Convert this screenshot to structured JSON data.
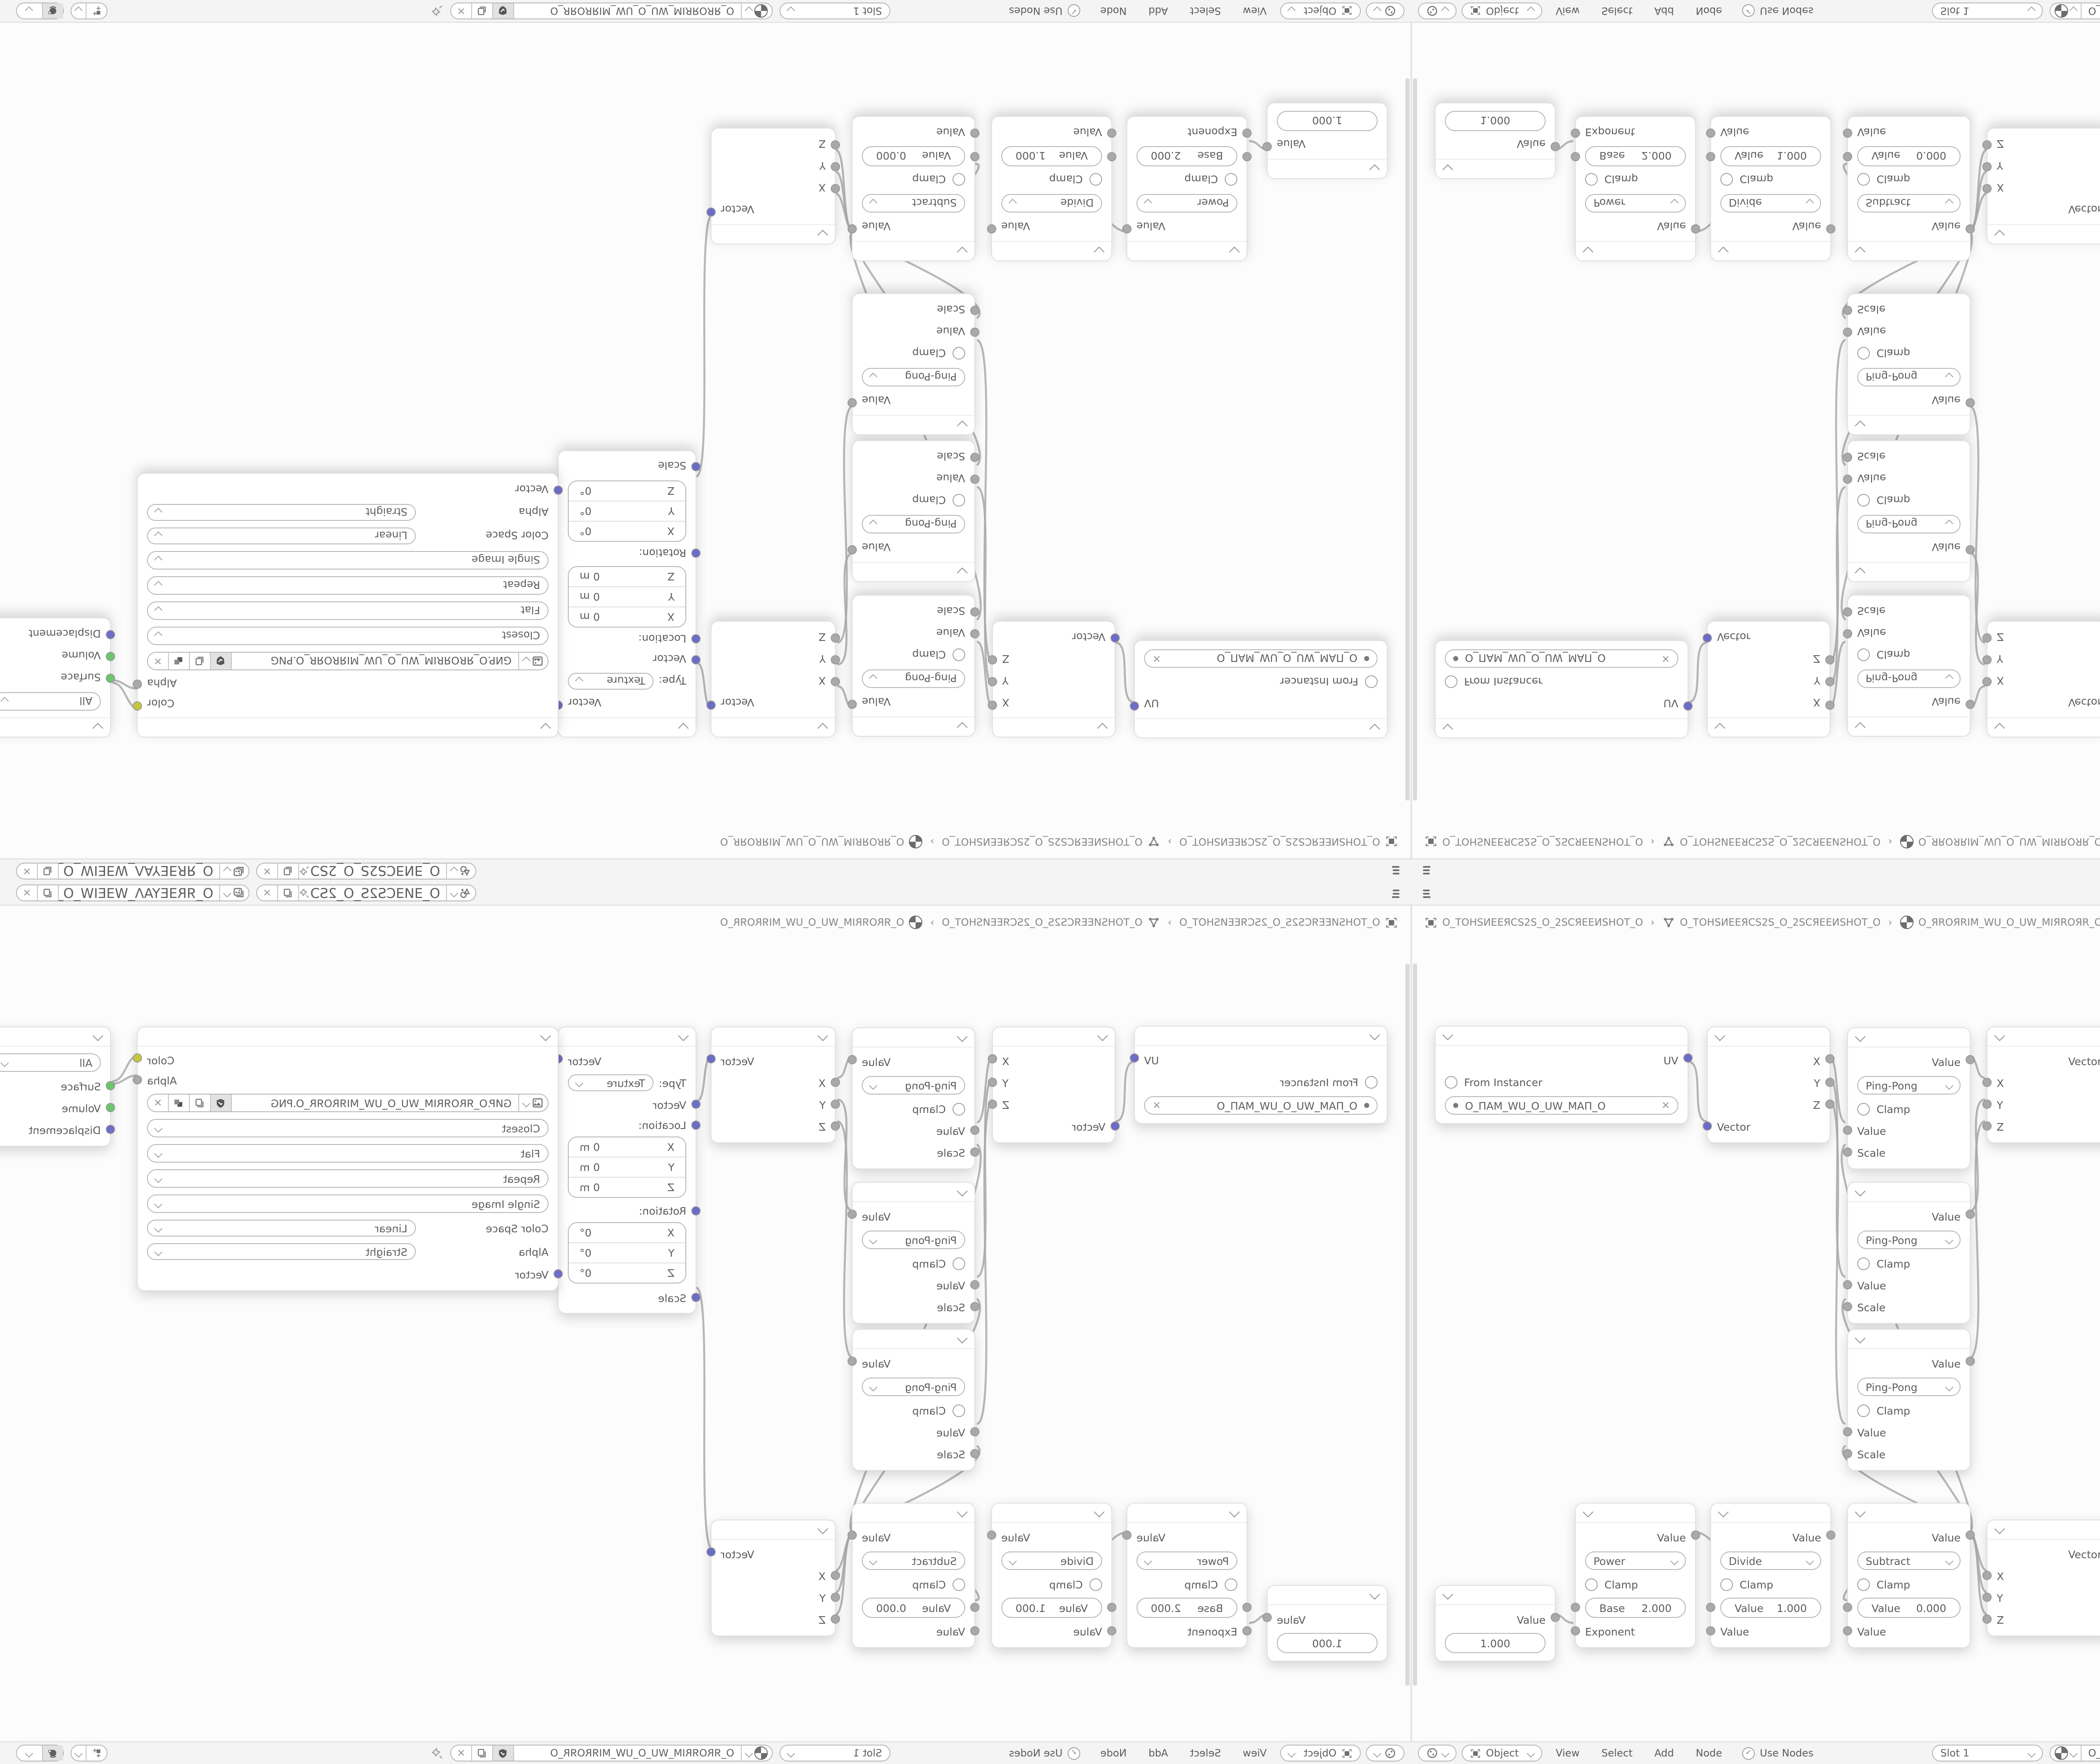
{
  "topbar": {
    "scene": "O_ƎИƎCS2S_O_2SƆƎИ...",
    "view_layer": "O_ЯRƎEYAΛ_WƎEIW_O_WIƎEW_ΛAYƎEЯR_O"
  },
  "breadcrumb": {
    "screen": "O_TOHSИEEЯCS2S_O_2SCЯEEИSHOT_O",
    "nodetree": "O_TOHSИEEЯCS2S_O_2SCЯEEИSHOT_O",
    "material": "O_ЯROЯRIM_WU_O_UW_MIЯROЯR_O",
    "sep": "›"
  },
  "header": {
    "shader_type": "Object",
    "menus": [
      "View",
      "Select",
      "Add",
      "Node"
    ],
    "use_nodes": "Use Nodes",
    "slot": "Slot 1",
    "material": "O_ЯROЯRIM_WU_O_UW_MIЯROЯR_O"
  },
  "nodes": {
    "uv_map": {
      "output": "UV",
      "from_instancer": "From Instancer",
      "uv_name": "O_ПAM_WU_O_UW_MAП_O"
    },
    "separate_xyz": {
      "x": "X",
      "y": "Y",
      "z": "Z",
      "vector": "Vector"
    },
    "pingpong": {
      "output": "Value",
      "operation": "Ping-Pong",
      "clamp": "Clamp",
      "value": "Value",
      "scale": "Scale"
    },
    "combine_xyz": {
      "output": "Vector",
      "x": "X",
      "y": "Y",
      "z": "Z"
    },
    "mapping": {
      "output": "Vector",
      "type_label": "Type:",
      "type": "Texture",
      "vector": "Vector",
      "location": {
        "label": "Location:",
        "rows": [
          [
            "X",
            "0 m"
          ],
          [
            "Y",
            "0 m"
          ],
          [
            "Z",
            "0 m"
          ]
        ]
      },
      "rotation": {
        "label": "Rotation:",
        "rows": [
          [
            "X",
            "0°"
          ],
          [
            "Y",
            "0°"
          ],
          [
            "Z",
            "0°"
          ]
        ]
      },
      "scale": "Scale"
    },
    "image": {
      "color": "Color",
      "alpha": "Alpha",
      "filename": "GИP.O_ЯROЯRIM_WU_O_UW_MIЯROЯR_O.PNG",
      "interpolation": "Closest",
      "projection": "Flat",
      "extension": "Repeat",
      "source": "Single Image",
      "color_space_label": "Color Space",
      "color_space": "Linear",
      "alpha_label": "Alpha",
      "alpha_mode": "Straight",
      "vector": "Vector"
    },
    "output": {
      "target": "All",
      "surface": "Surface",
      "volume": "Volume",
      "displacement": "Displacement"
    },
    "value": {
      "output": "Value",
      "value": "1.000"
    },
    "power": {
      "output": "Value",
      "operation": "Power",
      "clamp": "Clamp",
      "field_label": "Base",
      "field_value": "2.000",
      "input": "Exponent"
    },
    "divide": {
      "output": "Value",
      "operation": "Divide",
      "clamp": "Clamp",
      "field_label": "Value",
      "field_value": "1.000",
      "input": "Value"
    },
    "subtract": {
      "output": "Value",
      "operation": "Subtract",
      "clamp": "Clamp",
      "field_label": "Value",
      "field_value": "0.000",
      "input": "Value"
    }
  }
}
